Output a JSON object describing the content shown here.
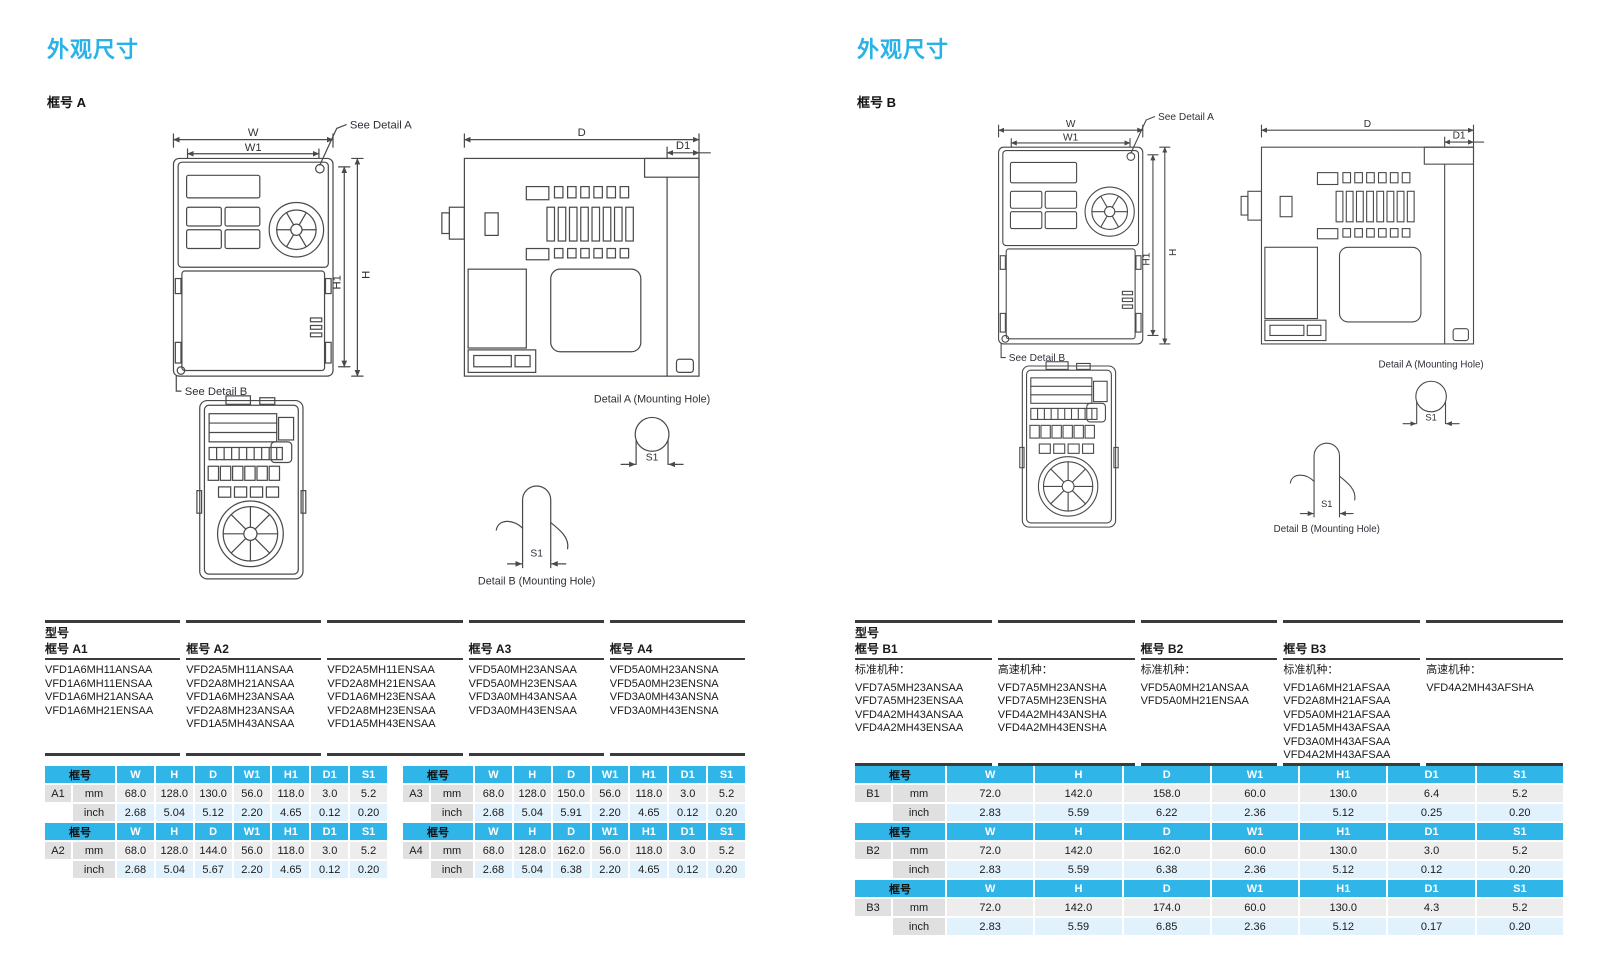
{
  "colors": {
    "accent": "#29b2e8",
    "table_header": "#2fb5e8",
    "row_mm_bg": "#ededed",
    "row_inch_bg": "#e2f2fc",
    "label_cell_bg": "#e0e0e0"
  },
  "drawing": {
    "w": "W",
    "w1": "W1",
    "h": "H",
    "h1": "H1",
    "d": "D",
    "d1": "D1",
    "s1": "S1",
    "see_detail_a": "See Detail A",
    "see_detail_b": "See Detail B",
    "detail_a_caption": "Detail A (Mounting Hole)",
    "detail_b_caption": "Detail B (Mounting Hole)"
  },
  "dim_headers": [
    "框号",
    "W",
    "H",
    "D",
    "W1",
    "H1",
    "D1",
    "S1"
  ],
  "units": {
    "mm": "mm",
    "inch": "inch"
  },
  "left": {
    "title": "外观尺寸",
    "frame_label": "框号 A",
    "model_table": {
      "title": "型号",
      "columns": [
        {
          "frame": "框号 A1",
          "models": [
            "VFD1A6MH11ANSAA",
            "VFD1A6MH11ENSAA",
            "VFD1A6MH21ANSAA",
            "VFD1A6MH21ENSAA"
          ]
        },
        {
          "frame": "框号 A2",
          "models": [
            "VFD2A5MH11ANSAA",
            "VFD2A8MH21ANSAA",
            "VFD1A6MH23ANSAA",
            "VFD2A8MH23ANSAA",
            "VFD1A5MH43ANSAA"
          ]
        },
        {
          "frame": "",
          "models": [
            "VFD2A5MH11ENSAA",
            "VFD2A8MH21ENSAA",
            "VFD1A6MH23ENSAA",
            "VFD2A8MH23ENSAA",
            "VFD1A5MH43ENSAA"
          ]
        },
        {
          "frame": "框号 A3",
          "models": [
            "VFD5A0MH23ANSAA",
            "VFD5A0MH23ENSAA",
            "VFD3A0MH43ANSAA",
            "VFD3A0MH43ENSAA"
          ]
        },
        {
          "frame": "框号 A4",
          "models": [
            "VFD5A0MH23ANSNA",
            "VFD5A0MH23ENSNA",
            "VFD3A0MH43ANSNA",
            "VFD3A0MH43ENSNA"
          ]
        }
      ]
    },
    "dim_tables": [
      {
        "id": "A1",
        "mm": [
          "68.0",
          "128.0",
          "130.0",
          "56.0",
          "118.0",
          "3.0",
          "5.2"
        ],
        "inch": [
          "2.68",
          "5.04",
          "5.12",
          "2.20",
          "4.65",
          "0.12",
          "0.20"
        ]
      },
      {
        "id": "A2",
        "mm": [
          "68.0",
          "128.0",
          "144.0",
          "56.0",
          "118.0",
          "3.0",
          "5.2"
        ],
        "inch": [
          "2.68",
          "5.04",
          "5.67",
          "2.20",
          "4.65",
          "0.12",
          "0.20"
        ]
      },
      {
        "id": "A3",
        "mm": [
          "68.0",
          "128.0",
          "150.0",
          "56.0",
          "118.0",
          "3.0",
          "5.2"
        ],
        "inch": [
          "2.68",
          "5.04",
          "5.91",
          "2.20",
          "4.65",
          "0.12",
          "0.20"
        ]
      },
      {
        "id": "A4",
        "mm": [
          "68.0",
          "128.0",
          "162.0",
          "56.0",
          "118.0",
          "3.0",
          "5.2"
        ],
        "inch": [
          "2.68",
          "5.04",
          "6.38",
          "2.20",
          "4.65",
          "0.12",
          "0.20"
        ]
      }
    ]
  },
  "right": {
    "title": "外观尺寸",
    "frame_label": "框号 B",
    "model_table": {
      "title": "型号",
      "columns": [
        {
          "frame": "框号 B1",
          "type": "标准机种：",
          "models": [
            "VFD7A5MH23ANSAA",
            "VFD7A5MH23ENSAA",
            "VFD4A2MH43ANSAA",
            "VFD4A2MH43ENSAA"
          ]
        },
        {
          "frame": "",
          "type": "高速机种：",
          "models": [
            "VFD7A5MH23ANSHA",
            "VFD7A5MH23ENSHA",
            "VFD4A2MH43ANSHA",
            "VFD4A2MH43ENSHA"
          ]
        },
        {
          "frame": "框号 B2",
          "type": "标准机种：",
          "models": [
            "VFD5A0MH21ANSAA",
            "VFD5A0MH21ENSAA"
          ]
        },
        {
          "frame": "框号 B3",
          "type": "标准机种：",
          "models": [
            "VFD1A6MH21AFSAA",
            "VFD2A8MH21AFSAA",
            "VFD5A0MH21AFSAA",
            "VFD1A5MH43AFSAA",
            "VFD3A0MH43AFSAA",
            "VFD4A2MH43AFSAA"
          ]
        },
        {
          "frame": "",
          "type": "高速机种：",
          "models": [
            "VFD4A2MH43AFSHA"
          ]
        }
      ]
    },
    "dim_tables": [
      {
        "id": "B1",
        "mm": [
          "72.0",
          "142.0",
          "158.0",
          "60.0",
          "130.0",
          "6.4",
          "5.2"
        ],
        "inch": [
          "2.83",
          "5.59",
          "6.22",
          "2.36",
          "5.12",
          "0.25",
          "0.20"
        ]
      },
      {
        "id": "B2",
        "mm": [
          "72.0",
          "142.0",
          "162.0",
          "60.0",
          "130.0",
          "3.0",
          "5.2"
        ],
        "inch": [
          "2.83",
          "5.59",
          "6.38",
          "2.36",
          "5.12",
          "0.12",
          "0.20"
        ]
      },
      {
        "id": "B3",
        "mm": [
          "72.0",
          "142.0",
          "174.0",
          "60.0",
          "130.0",
          "4.3",
          "5.2"
        ],
        "inch": [
          "2.83",
          "5.59",
          "6.85",
          "2.36",
          "5.12",
          "0.17",
          "0.20"
        ]
      }
    ]
  }
}
